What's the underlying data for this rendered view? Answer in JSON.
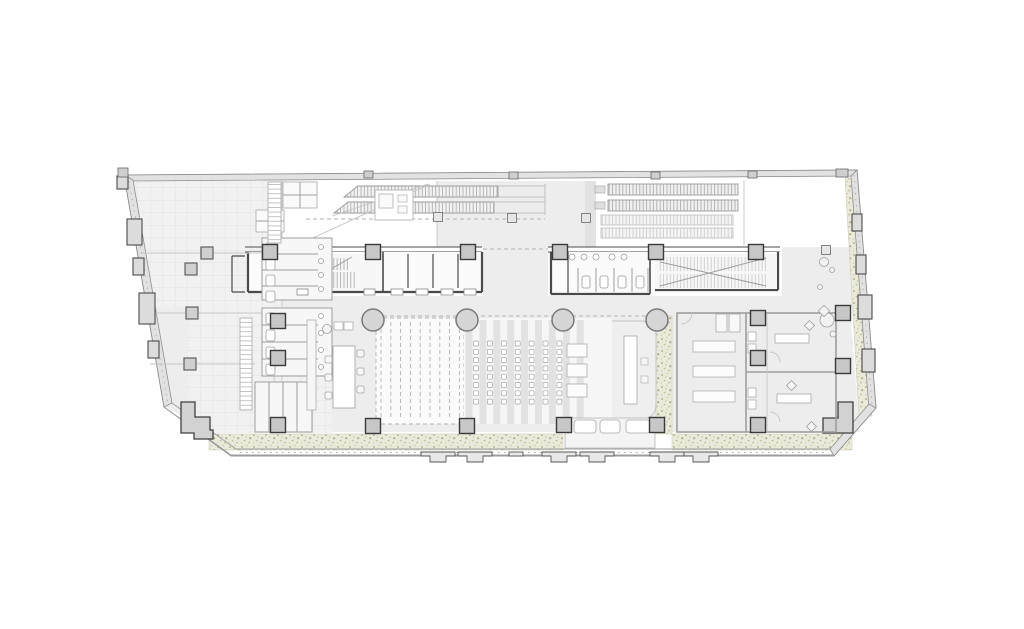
{
  "page": {
    "background": "#ffffff"
  },
  "plan": {
    "palette": {
      "wall_dark": "#4a4a4a",
      "wall_mid": "#8f8f8f",
      "line_light": "#c6c6c6",
      "floor": "#ededed",
      "grid_line": "#dcdcdc",
      "col_fill": "#c7c7c7",
      "col_stroke": "#3a3a3a",
      "round_fill": "#d6d6d6",
      "round_stroke": "#7a7a7a",
      "green_base": "#eaeada",
      "green_dot": "#b0b08c",
      "fixture": "#9e9e9e",
      "white": "#ffffff"
    },
    "columns": {
      "square": [
        [
          270,
          252
        ],
        [
          373,
          252
        ],
        [
          468,
          252
        ],
        [
          560,
          252
        ],
        [
          656,
          252
        ],
        [
          756,
          252
        ],
        [
          278,
          321
        ],
        [
          278,
          358
        ],
        [
          278,
          425
        ],
        [
          373,
          426
        ],
        [
          467,
          426
        ],
        [
          564,
          425
        ],
        [
          657,
          425
        ],
        [
          758,
          425
        ],
        [
          758,
          318
        ],
        [
          758,
          358
        ],
        [
          843,
          313
        ],
        [
          843,
          366
        ]
      ],
      "square_size": 15,
      "wall_small": [
        [
          207,
          253
        ],
        [
          191,
          269
        ],
        [
          192,
          313
        ],
        [
          190,
          364
        ]
      ],
      "wall_small_size": 12,
      "mini": [
        [
          438,
          217
        ],
        [
          512,
          218
        ],
        [
          586,
          218
        ],
        [
          826,
          250
        ]
      ],
      "mini_size": 9,
      "round": [
        [
          373,
          320
        ],
        [
          467,
          320
        ],
        [
          563,
          320
        ],
        [
          657,
          320
        ]
      ],
      "round_radius": 11
    },
    "pilasters": {
      "left": [
        [
          117,
          176,
          11,
          13
        ],
        [
          127,
          219,
          15,
          26
        ],
        [
          133,
          258,
          11,
          17
        ],
        [
          139,
          293,
          16,
          31
        ],
        [
          148,
          341,
          11,
          17
        ]
      ],
      "right": [
        [
          852,
          214,
          10,
          17
        ],
        [
          856,
          255,
          10,
          19
        ],
        [
          858,
          295,
          14,
          24
        ],
        [
          862,
          349,
          13,
          23
        ]
      ],
      "top_notches": [
        [
          364,
          171,
          9,
          7
        ],
        [
          509,
          172,
          9,
          7
        ],
        [
          651,
          172,
          9,
          7
        ],
        [
          748,
          171,
          9,
          7
        ],
        [
          836,
          169,
          12,
          8
        ],
        [
          118,
          168,
          10,
          9
        ]
      ],
      "bottom_tab_centers": [
        438,
        475,
        559,
        597,
        667,
        701
      ],
      "bottom_small_bars": [
        [
          509,
          452,
          14,
          4
        ]
      ]
    },
    "corner_steps": {
      "left_path": "M181,402 L195,402 L195,417 L210,417 L210,430 L213,430 L213,439 L194,439 L194,433 L181,433 Z",
      "right_path": "M838,402 L853,402 L853,433 L823,433 L823,418 L838,418 Z"
    },
    "green_bands": {
      "rects": [
        [
          209,
          434,
          354,
          16
        ],
        [
          672,
          434,
          180,
          16
        ],
        [
          656,
          316,
          16,
          118
        ]
      ],
      "right_poly": "845,178 857,178 872,416 859,416"
    },
    "escalators": {
      "bank_a_runs": [
        "358,186 498,186 498,197 344,197",
        "348,202 494,202 494,213 334,213"
      ],
      "bank_a_rails": [
        [
          498,
          186,
          545,
          186
        ],
        [
          498,
          197,
          545,
          197
        ],
        [
          494,
          202,
          545,
          202
        ],
        [
          494,
          213,
          545,
          213
        ],
        [
          545,
          184,
          545,
          215
        ]
      ],
      "bank_a_diagonals": [
        [
          302,
          243,
          430,
          184
        ],
        [
          332,
          216,
          428,
          184
        ]
      ],
      "bank_b_dark": [
        [
          608,
          184,
          130,
          11
        ],
        [
          608,
          200,
          130,
          11
        ]
      ],
      "bank_b_light": [
        [
          601,
          215,
          132,
          10
        ],
        [
          601,
          228,
          132,
          10
        ]
      ],
      "bank_b_connectors": [
        [
          595,
          186,
          10,
          7
        ],
        [
          595,
          202,
          10,
          7
        ]
      ]
    },
    "auditorium": {
      "ramp": {
        "x": 376,
        "y": 318,
        "w": 88,
        "h": 106,
        "dash_x0": 381,
        "dash_step": 9.8,
        "dash_count": 9
      },
      "stripes": {
        "x0": 465.5,
        "step": 13.9,
        "count": 9,
        "w": 7,
        "y": 320,
        "h": 104
      },
      "seats": {
        "x0": 473.5,
        "y0": 341,
        "dx": 13.9,
        "dy": 8.3,
        "cols": 7,
        "rows": 8,
        "size": 5
      },
      "tables": [
        [
          567,
          344,
          20,
          13
        ],
        [
          567,
          364,
          20,
          13
        ],
        [
          567,
          384,
          20,
          13
        ]
      ],
      "stage_table": [
        624,
        336,
        13,
        68
      ],
      "stage_pads": [
        [
          641,
          358,
          7,
          7
        ],
        [
          641,
          376,
          7,
          7
        ]
      ]
    },
    "fixtures": {
      "wc_upper": {
        "block": [
          262,
          238,
          70,
          62
        ],
        "rows": [
          254,
          270,
          286
        ],
        "wc_y": [
          241,
          257,
          273,
          289
        ],
        "circle_y": [
          247,
          261,
          275,
          289
        ]
      },
      "wc_lower": {
        "block": [
          262,
          308,
          70,
          68
        ],
        "rows": [
          325,
          342,
          359
        ],
        "wc_y": [
          311,
          328,
          345,
          362
        ],
        "circle_y": [
          316,
          333,
          350,
          367
        ]
      },
      "cubicles": {
        "block": [
          255,
          382,
          57,
          50
        ],
        "dividers_x": [
          269,
          283,
          297
        ]
      },
      "core_wc": {
        "circles_x": [
          572,
          584,
          596,
          612,
          624
        ],
        "circles_y": 257,
        "stall_x": [
          578,
          596,
          614,
          632,
          648
        ],
        "stall_y1": 268,
        "stall_y2": 292,
        "wc_x": [
          582,
          600,
          618,
          636
        ],
        "wc_y": 276
      },
      "elevator_sills": [
        [
          391,
          289,
          12,
          6
        ],
        [
          416,
          289,
          12,
          6
        ],
        [
          441,
          289,
          12,
          6
        ],
        [
          464,
          289,
          12,
          6
        ],
        [
          297,
          289,
          11,
          6
        ],
        [
          364,
          289,
          11,
          6
        ]
      ],
      "sink_room": {
        "rect": [
          565,
          418,
          90,
          30
        ],
        "sinks": [
          [
            574,
            420,
            22,
            13
          ],
          [
            600,
            420,
            20,
            13
          ],
          [
            626,
            420,
            24,
            13
          ]
        ]
      },
      "bath_mid": [
        [
          748,
          332,
          8,
          9
        ],
        [
          748,
          344,
          8,
          9
        ],
        [
          748,
          388,
          8,
          9
        ],
        [
          748,
          400,
          8,
          9
        ]
      ]
    },
    "furniture": {
      "conference": {
        "cabinet": [
          307,
          320,
          9,
          90
        ],
        "counter": [
          [
            334,
            322,
            9,
            8
          ],
          [
            344,
            322,
            9,
            8
          ]
        ],
        "table": [
          333,
          346,
          22,
          62
        ],
        "chairs_left": [
          [
            325,
            356
          ],
          [
            325,
            374
          ],
          [
            325,
            392
          ]
        ],
        "chairs_right": [
          [
            357,
            350
          ],
          [
            357,
            368
          ],
          [
            357,
            386
          ]
        ],
        "plant": [
          327,
          329,
          4.5
        ]
      },
      "tables_room": {
        "tables": [
          [
            693,
            341,
            42,
            11
          ],
          [
            693,
            366,
            42,
            11
          ],
          [
            693,
            391,
            42,
            11
          ]
        ],
        "lockers": [
          [
            716,
            314,
            11,
            18
          ],
          [
            729,
            314,
            11,
            18
          ]
        ]
      },
      "bedrooms": {
        "desks": [
          [
            775,
            334,
            34,
            9
          ],
          [
            777,
            394,
            34,
            9
          ]
        ],
        "chair_diamonds": [
          [
            806,
            322
          ],
          [
            788,
            382
          ],
          [
            808,
            423
          ]
        ]
      },
      "plants_right": [
        [
          824,
          262,
          4.5
        ],
        [
          832,
          270,
          2.5
        ],
        [
          827,
          320,
          7
        ],
        [
          833,
          334,
          3
        ],
        [
          820,
          287,
          2.5
        ]
      ],
      "diamond": [
        820,
        307,
        8
      ],
      "kitchen": {
        "outline": [
          375,
          190,
          38,
          30
        ],
        "island": [
          379,
          194,
          14,
          14
        ],
        "small": [
          [
            398,
            195,
            9,
            7
          ],
          [
            398,
            206,
            9,
            7
          ]
        ]
      },
      "lockers_nw": {
        "blocks": [
          [
            283,
            182,
            34,
            26
          ],
          [
            256,
            210,
            28,
            22
          ]
        ]
      },
      "ladders": [
        [
          268,
          182,
          13,
          61
        ],
        [
          240,
          318,
          12,
          92
        ]
      ]
    },
    "dashed_lines": [
      [
        483,
        249,
        548,
        249
      ],
      [
        376,
        316,
        654,
        316
      ],
      [
        306,
        219,
        545,
        219
      ]
    ],
    "tie_lines": [
      [
        140,
        253,
        262,
        253
      ],
      [
        144,
        313,
        262,
        313
      ],
      [
        150,
        364,
        255,
        364
      ]
    ]
  }
}
